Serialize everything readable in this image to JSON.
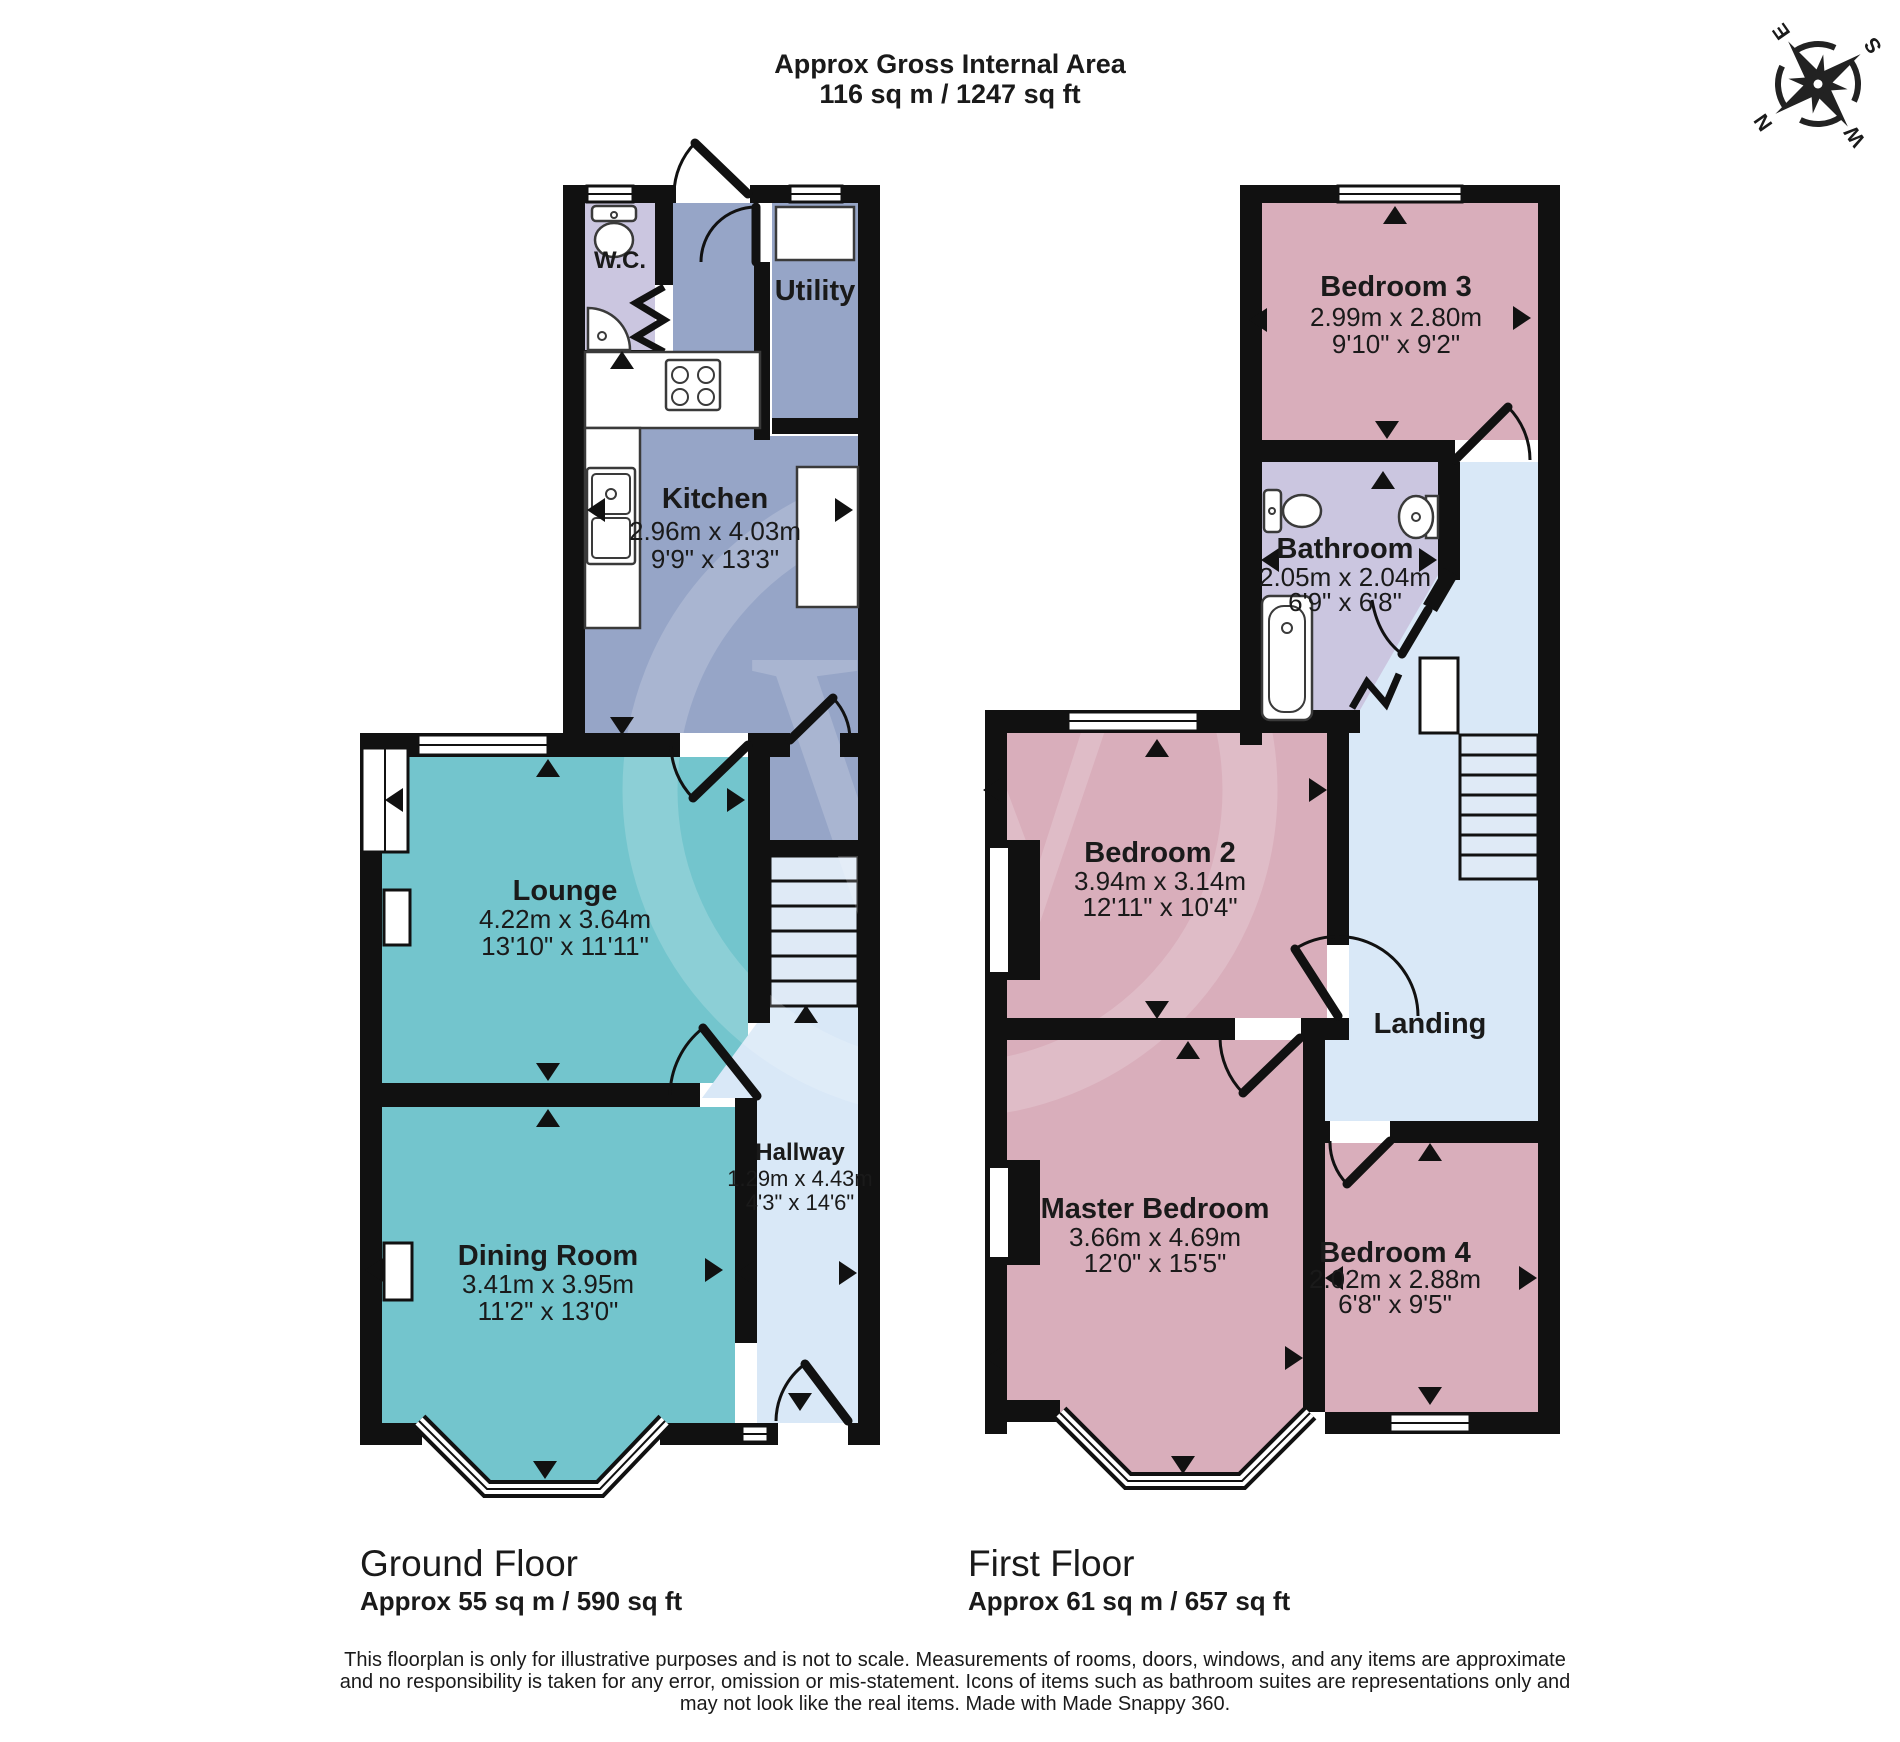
{
  "header": {
    "line1": "Approx Gross Internal Area",
    "line2": "116 sq m / 1247 sq ft"
  },
  "compass": {
    "north": "N",
    "east": "E",
    "south": "S",
    "west": "W"
  },
  "floors": {
    "ground": {
      "label": "Ground Floor",
      "area": "Approx 55 sq m / 590 sq ft",
      "rooms": {
        "wc": {
          "name": "W.C."
        },
        "utility": {
          "name": "Utility"
        },
        "kitchen": {
          "name": "Kitchen",
          "dim_m": "2.96m x 4.03m",
          "dim_ft": "9'9\" x 13'3\""
        },
        "lounge": {
          "name": "Lounge",
          "dim_m": "4.22m x 3.64m",
          "dim_ft": "13'10\" x 11'11\""
        },
        "dining": {
          "name": "Dining Room",
          "dim_m": "3.41m x 3.95m",
          "dim_ft": "11'2\" x 13'0\""
        },
        "hallway": {
          "name": "Hallway",
          "dim_m": "1.29m x 4.43m",
          "dim_ft": "4'3\" x 14'6\""
        }
      }
    },
    "first": {
      "label": "First Floor",
      "area": "Approx 61 sq m / 657 sq ft",
      "rooms": {
        "bedroom3": {
          "name": "Bedroom 3",
          "dim_m": "2.99m x 2.80m",
          "dim_ft": "9'10\" x 9'2\""
        },
        "bathroom": {
          "name": "Bathroom",
          "dim_m": "2.05m x 2.04m",
          "dim_ft": "6'9\" x 6'8\""
        },
        "bedroom2": {
          "name": "Bedroom 2",
          "dim_m": "3.94m x 3.14m",
          "dim_ft": "12'11\" x 10'4\""
        },
        "landing": {
          "name": "Landing"
        },
        "master": {
          "name": "Master Bedroom",
          "dim_m": "3.66m x 4.69m",
          "dim_ft": "12'0\" x 15'5\""
        },
        "bedroom4": {
          "name": "Bedroom 4",
          "dim_m": "2.02m x 2.88m",
          "dim_ft": "6'8\" x 9'5\""
        }
      }
    }
  },
  "footer": {
    "disclaimer_lines": [
      "This floorplan is only for illustrative purposes and is not to scale. Measurements of rooms, doors, windows, and any items are approximate",
      "and no responsibility is taken for any error, omission or mis-statement. Icons of items such as bathroom suites are representations only and",
      "may not look like the real items. Made with Made Snappy 360."
    ]
  },
  "colors": {
    "wall": "#111111",
    "bedroom_pink": "#d9aebb",
    "living_teal": "#73c5cd",
    "kitchen_blue": "#96a5c7",
    "bath_lavender": "#cbc6e0",
    "hall_blue": "#d9e8f7",
    "stairs_blue": "#dfeaf6"
  }
}
